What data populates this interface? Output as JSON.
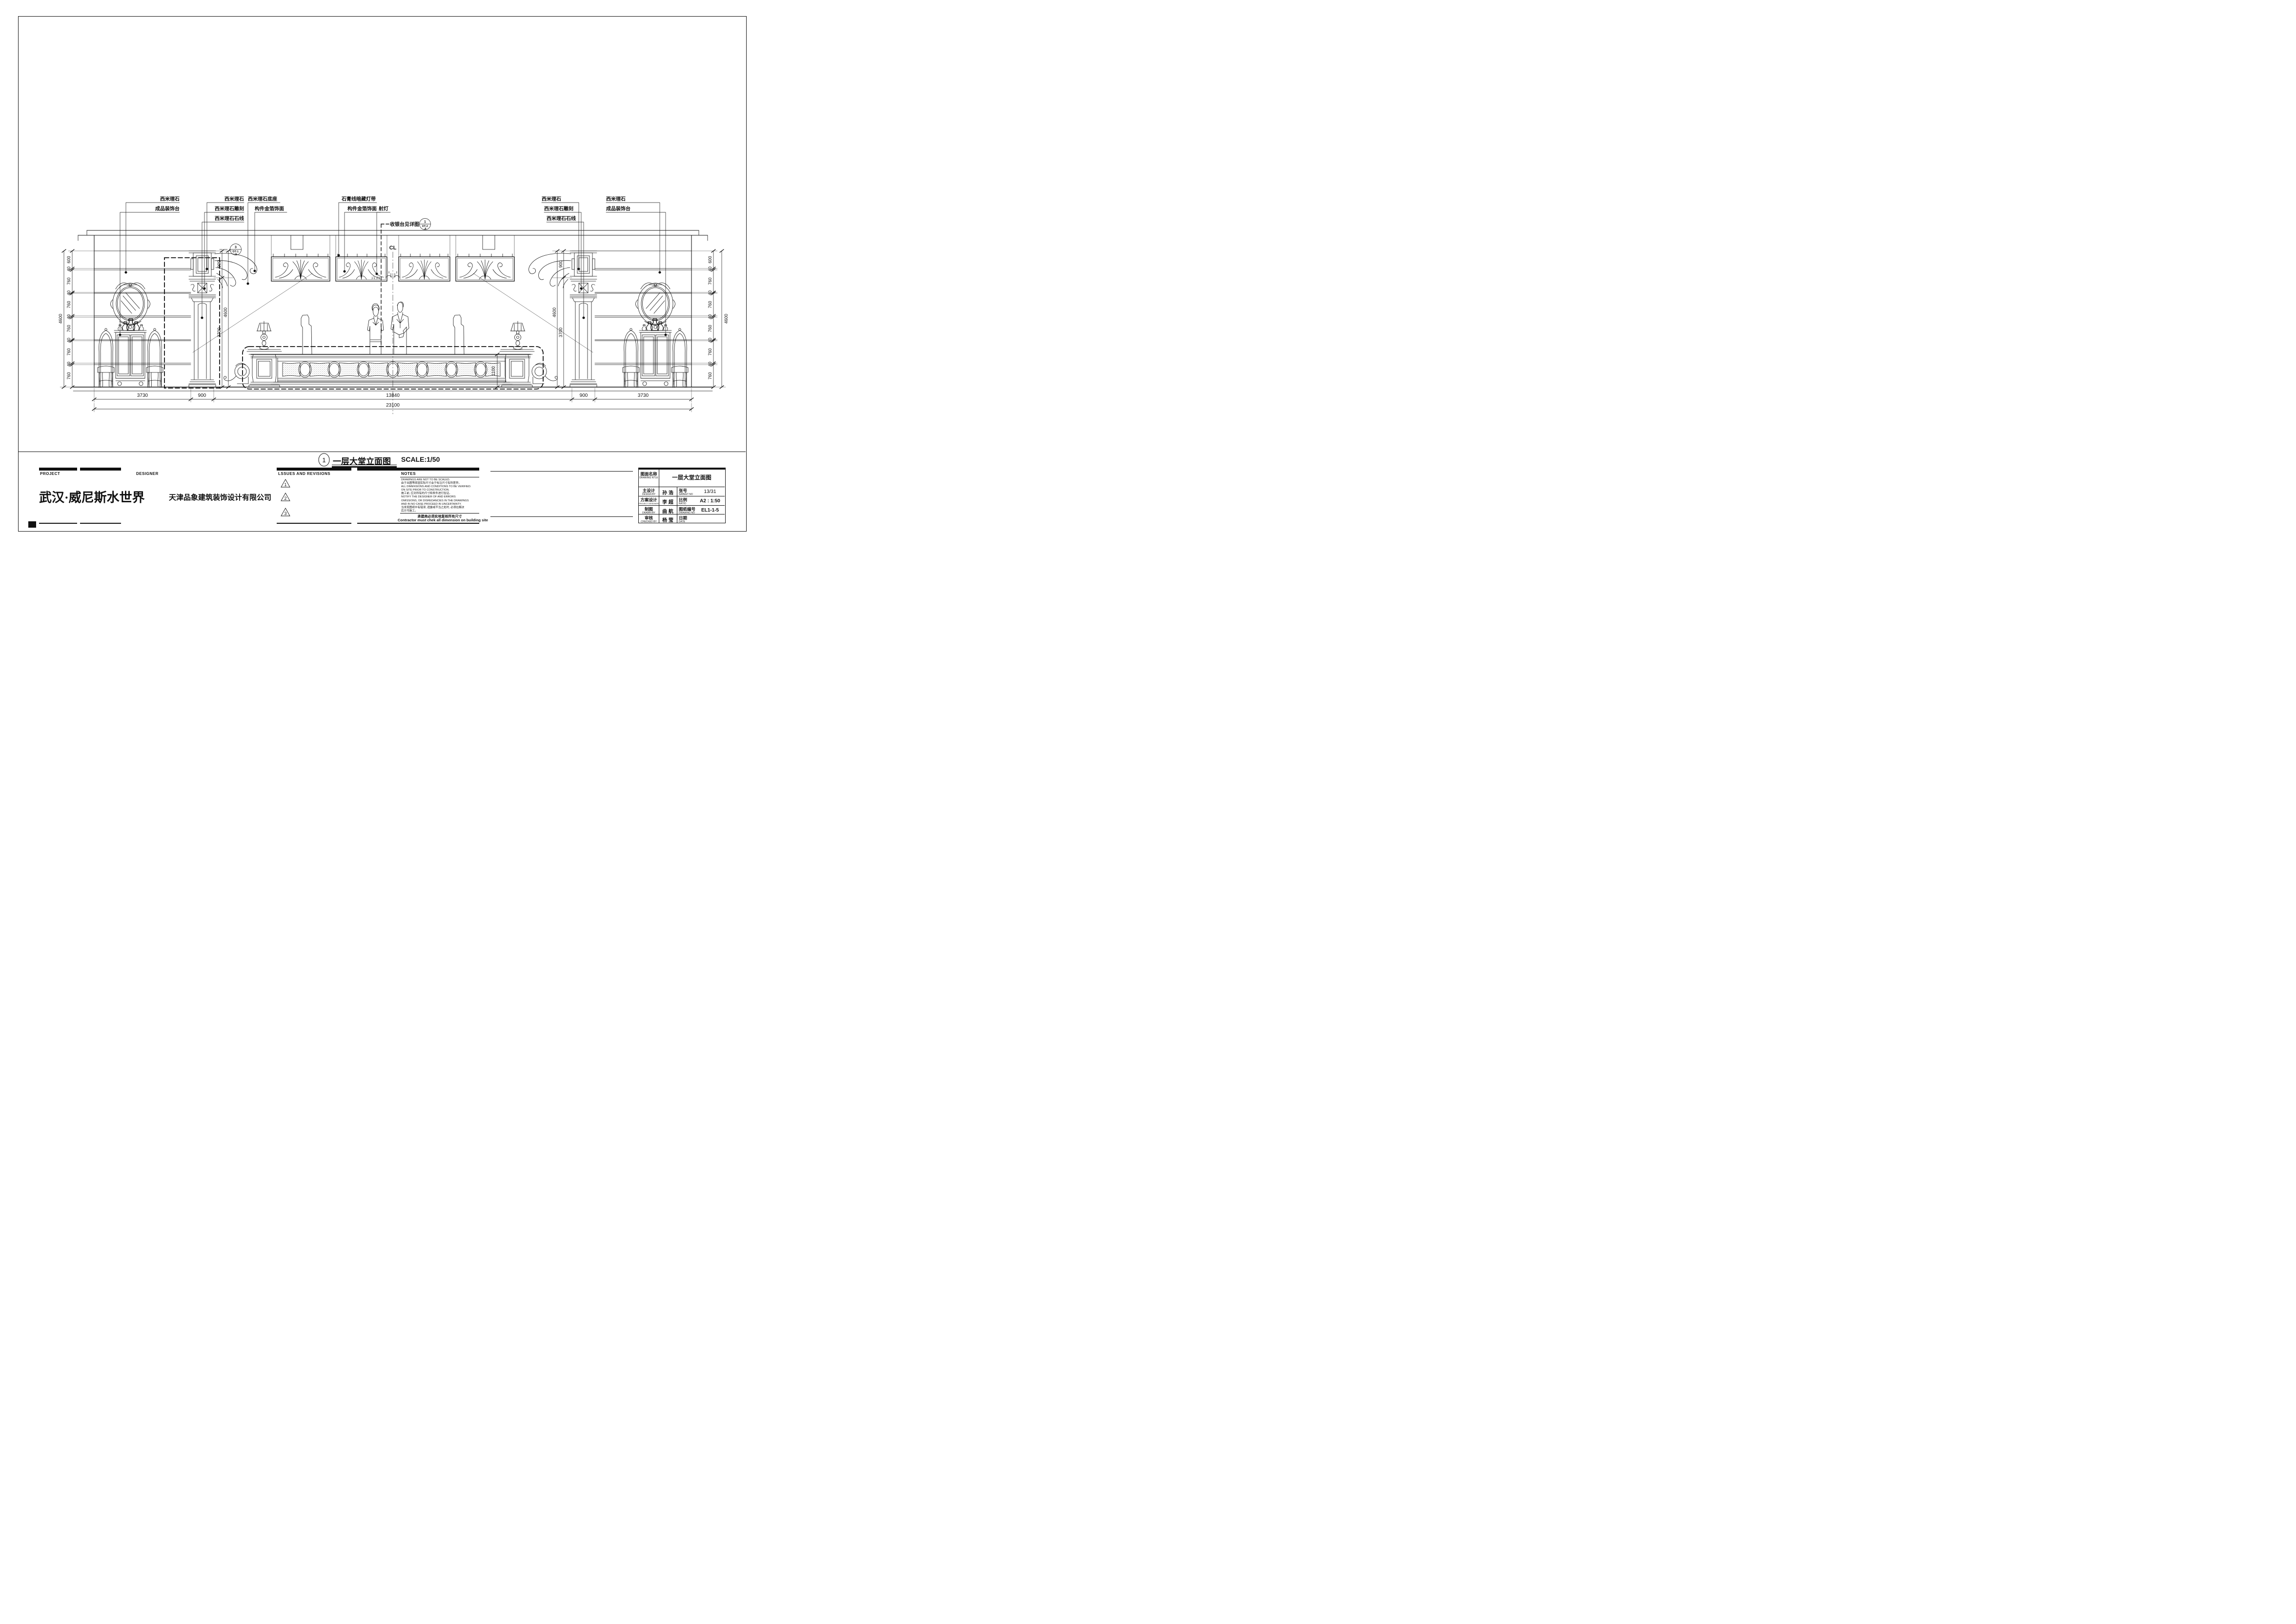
{
  "drawing": {
    "title_number": "1",
    "title": "一层大堂立面图",
    "scale": "SCALE:1/50",
    "centerline": "CL"
  },
  "callouts": {
    "left_wall": [
      "西米理石",
      "成品装饰台"
    ],
    "left_pilaster": [
      "西米理石",
      "西米理石雕刻",
      "西米理石石线"
    ],
    "left_base": [
      "西米理石底座",
      "构件金箔饰面"
    ],
    "ceiling": [
      "石膏线暗藏灯带",
      "构件金箔饰面"
    ],
    "spotlight": "射灯",
    "cashier": "收银台见详图",
    "right_pilaster": [
      "西米理石",
      "西米理石雕刻",
      "西米理石石线"
    ],
    "right_wall": [
      "西米理石",
      "成品装饰台"
    ],
    "detail_cashier": {
      "num": "1",
      "code": "DT-2",
      "code2": "-8"
    },
    "detail_pilaster": {
      "num": "3",
      "code": "DT-1",
      "code2": "-6"
    }
  },
  "dims": {
    "left_chain": [
      "600",
      "40",
      "760",
      "40",
      "760",
      "40",
      "760",
      "40",
      "760",
      "40",
      "760"
    ],
    "left_total": "4600",
    "right_chain": [
      "600",
      "40",
      "760",
      "40",
      "760",
      "40",
      "760",
      "40",
      "760",
      "40",
      "760"
    ],
    "right_total": "4600",
    "pilaster_top_left": "900",
    "wall_height_left": "4600",
    "clear_height_left": "3700",
    "pilaster_top_right": "900",
    "wall_height_right": "4600",
    "clear_height_right": "3700",
    "desk_height": "1100",
    "bottom": [
      "3730",
      "900",
      "13840",
      "900",
      "3730"
    ],
    "bottom_total": "23100"
  },
  "titleblock": {
    "project_label": "PROJECT",
    "project_name": "武汉·威尼斯水世界",
    "designer_label": "DESIGNER",
    "designer_name": "天津品象建筑装饰设计有限公司",
    "revisions_label": "LSSUES AND REVISIONS",
    "revision_marks": [
      "1",
      "2",
      "3"
    ],
    "notes_label": "NOTES",
    "notes_lines": [
      "DRAWINGS ARE NOT TO BE SCALED.",
      "由于出图等原因实际尺寸会于标注尺寸有所差异。",
      "ALL DIMENSIONS AND CONDITIONS TO BE VERIFIED.",
      "ON SITE PRIOR TO CONSTRUCTION.",
      "施工前, 应对所有的尺寸和条件进行验证。",
      "NOTIFY THE DESIGNER OF AND ERRORS",
      "OMISSIONS, OR DISREDANCIES IN THE DRAWINGS",
      "AND IN NO CASE PROCEED IN UNCERTAINTY.",
      "当发现图纸中有错误, 遗露或不当之处时, 必须在解决",
      "后方可施工。"
    ],
    "contractor_cn": "承建商必须实地复核所有尺寸",
    "contractor_en": "Contractor must chek all dimension on building site",
    "table": {
      "name_label_cn": "图面名称",
      "name_label_en": "DRAWING NTLE",
      "name_value": "一层大堂立面图",
      "rows": [
        {
          "label_cn": "主设计",
          "label_en": "DESIGN BY",
          "value": "孙 浩",
          "label2_cn": "张号",
          "label2_en": "SAHEET NO",
          "value2": "13/31"
        },
        {
          "label_cn": "方案设计",
          "label_en": "PROJECT DESIGNER",
          "value": "李 超",
          "label2_cn": "比例",
          "label2_en": "RATIO",
          "value2": "A2 : 1:50"
        },
        {
          "label_cn": "制图",
          "label_en": "DRAWN BY",
          "value": "曲 航",
          "label2_cn": "图纸编号",
          "label2_en": "DRAWING NO",
          "value2": "EL1-1-5"
        },
        {
          "label_cn": "审核",
          "label_en": "CHECKED BY",
          "value": "杨 莹",
          "label2_cn": "日期",
          "label2_en": "DATE",
          "value2": ""
        }
      ]
    }
  }
}
